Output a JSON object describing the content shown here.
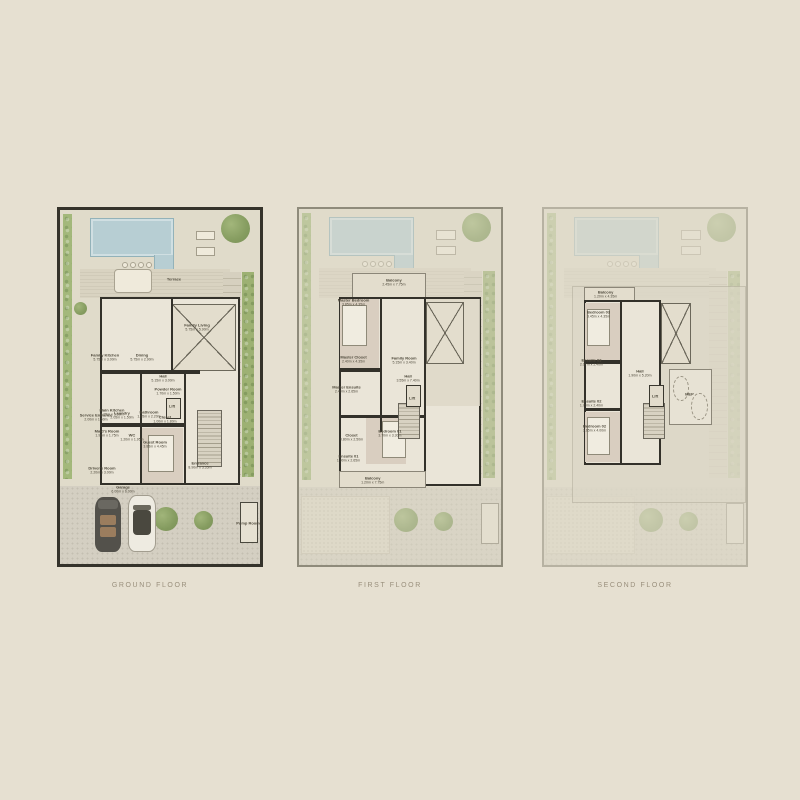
{
  "page": {
    "background": "#e6e0d1",
    "colors": {
      "pool": "#b7ced3",
      "garden": "#a3b87b",
      "walls": "#33312a",
      "plan_paper": "#e0dbca",
      "caption_text": "#998f7c",
      "room_text": "#4f4a3c"
    }
  },
  "floors": [
    {
      "id": "ground",
      "caption": "GROUND FLOOR",
      "rooms": [
        {
          "name": "Terrace",
          "dims": "",
          "x": 57,
          "y": 19.5
        },
        {
          "name": "Family Kitchen",
          "dims": "5.75m x 3.00m",
          "x": 22.5,
          "y": 41.5
        },
        {
          "name": "Dining",
          "dims": "5.75m x 2.90m",
          "x": 41,
          "y": 41.5
        },
        {
          "name": "Family Living",
          "dims": "5.75m x 5.90m",
          "x": 68.5,
          "y": 33
        },
        {
          "name": "Hall",
          "dims": "5.15m x 3.00m",
          "x": 51.5,
          "y": 47.5
        },
        {
          "name": "Powder Room",
          "dims": "1.70m x 1.50m",
          "x": 54,
          "y": 51
        },
        {
          "name": "Lift",
          "dims": "",
          "x": 56,
          "y": 55.5
        },
        {
          "name": "Main Kitchen",
          "dims": "3.05m x 3.60m",
          "x": 26,
          "y": 57
        },
        {
          "name": "Service Entrance",
          "dims": "2.00m x 1.50m",
          "x": 18,
          "y": 58.5
        },
        {
          "name": "Laundry",
          "dims": "2.05m x 1.50m",
          "x": 31,
          "y": 58
        },
        {
          "name": "Bathroom",
          "dims": "1.95m x 2.20m",
          "x": 44.5,
          "y": 57.5
        },
        {
          "name": "Closet",
          "dims": "1.00m x 1.80m",
          "x": 52.5,
          "y": 59
        },
        {
          "name": "Maid's Room",
          "dims": "1.90m x 1.75m",
          "x": 23.5,
          "y": 63
        },
        {
          "name": "WC",
          "dims": "1.20m x 1.95m",
          "x": 36,
          "y": 64
        },
        {
          "name": "Guest Room",
          "dims": "3.85m x 4.45m",
          "x": 47.5,
          "y": 66
        },
        {
          "name": "Driver's Room",
          "dims": "2.20m x 3.00m",
          "x": 21,
          "y": 73.5
        },
        {
          "name": "Entrance",
          "dims": "8.90m x 3.35m",
          "x": 70,
          "y": 72
        },
        {
          "name": "Garage",
          "dims": "6.00m x 6.00m",
          "x": 31.5,
          "y": 78.8
        },
        {
          "name": "Pump Room",
          "dims": "",
          "x": 94,
          "y": 88.3
        }
      ]
    },
    {
      "id": "first",
      "caption": "FIRST FLOOR",
      "rooms": [
        {
          "name": "Balcony",
          "dims": "2.45m x 7.75m",
          "x": 47,
          "y": 20.5
        },
        {
          "name": "Master Bedroom",
          "dims": "3.85m x 4.35m",
          "x": 27,
          "y": 26
        },
        {
          "name": "Master Closet",
          "dims": "2.40m x 4.35m",
          "x": 27,
          "y": 42
        },
        {
          "name": "Master Ensuite",
          "dims": "2.40m x 2.65m",
          "x": 23.5,
          "y": 50.5
        },
        {
          "name": "Family Room",
          "dims": "5.15m x 3.40m",
          "x": 52,
          "y": 42.5
        },
        {
          "name": "Hall",
          "dims": "3.55m x 7.40m",
          "x": 54,
          "y": 47.5
        },
        {
          "name": "Lift",
          "dims": "",
          "x": 56,
          "y": 53
        },
        {
          "name": "Closet",
          "dims": "0.80m x 2.50m",
          "x": 26,
          "y": 64
        },
        {
          "name": "Ensuite 01",
          "dims": "1.90m x 2.65m",
          "x": 24.5,
          "y": 70
        },
        {
          "name": "Bedroom 01",
          "dims": "3.70m x 3.30m",
          "x": 45,
          "y": 63
        },
        {
          "name": "Balcony",
          "dims": "1.20m x 7.75m",
          "x": 36.5,
          "y": 76
        }
      ]
    },
    {
      "id": "second",
      "caption": "SECOND FLOOR",
      "rooms": [
        {
          "name": "Balcony",
          "dims": "1.20m x 4.35m",
          "x": 30.5,
          "y": 24
        },
        {
          "name": "Bedroom 03",
          "dims": "3.45m x 4.35m",
          "x": 27,
          "y": 29.5
        },
        {
          "name": "Ensuite 03",
          "dims": "2.07m x 2.40m",
          "x": 23.5,
          "y": 43
        },
        {
          "name": "Hall",
          "dims": "1.90m x 5.20m",
          "x": 47.5,
          "y": 46
        },
        {
          "name": "Lift",
          "dims": "",
          "x": 55,
          "y": 52.5
        },
        {
          "name": "Ensuite 02",
          "dims": "1.70m x 2.40m",
          "x": 23.5,
          "y": 54.5
        },
        {
          "name": "Bedroom 02",
          "dims": "3.65m x 4.00m",
          "x": 25,
          "y": 61.5
        },
        {
          "name": "MEP",
          "dims": "",
          "x": 72,
          "y": 52
        }
      ]
    }
  ]
}
